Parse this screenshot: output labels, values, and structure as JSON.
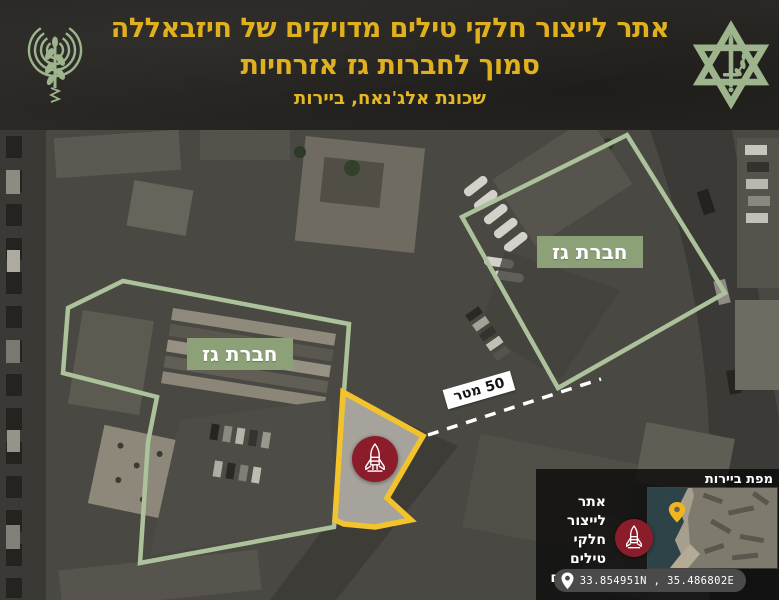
{
  "header": {
    "title_line1": "אתר לייצור חלקי טילים מדויקים של חיזבאללה",
    "title_line2": "סמוך לחברות גז אזרחיות",
    "subtitle": "שכונת אלג'נאח, ביירות"
  },
  "map": {
    "gas_company_label_1": "חברת גז",
    "gas_company_label_2": "חברת גז",
    "distance_label": "50 מטר"
  },
  "inset": {
    "title": "מפת ביירות",
    "site_line1": "אתר לייצור",
    "site_line2": "חלקי טילים",
    "site_line3": "מדוייקים",
    "coordinates": "33.854951N , 35.486802E"
  },
  "colors": {
    "header_background": "#2a2824",
    "title_yellow": "#e0b01e",
    "sage_green": "#9db48d",
    "polygon_green": "#abc29a",
    "label_green": "#8ca177",
    "polygon_yellow": "#f2c32d",
    "rocket_red": "#8b1d2b",
    "minimap_pin_yellow": "#f0b51f"
  },
  "icons": {
    "header_left": "radio-antenna-olive-branch-icon",
    "header_right": "idf-star-sword-olive-icon",
    "site_marker": "rocket-icon",
    "coordinates_marker": "location-pin-icon",
    "minimap_marker": "map-pin-icon"
  }
}
